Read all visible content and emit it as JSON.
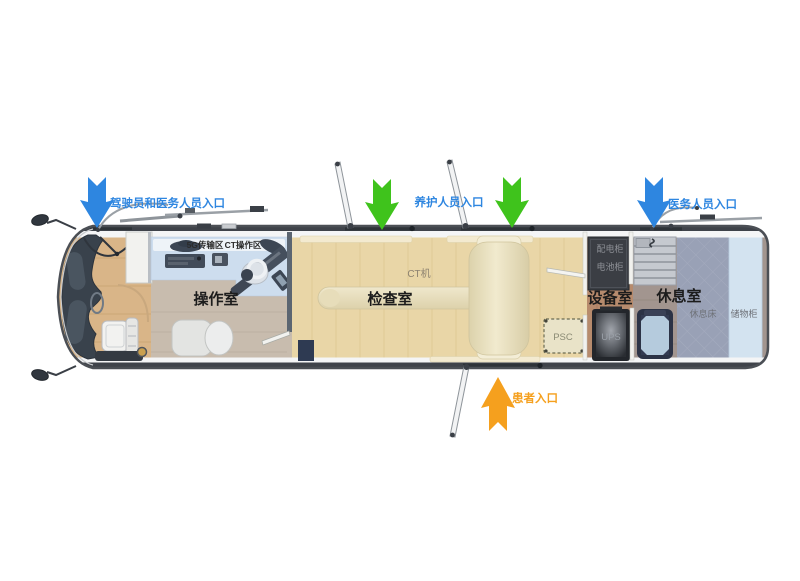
{
  "diagram": {
    "type": "vehicle-floorplan",
    "subject": "mobile CT medical vehicle top view"
  },
  "entrances": {
    "driver_staff": {
      "label": "驾驶员和医务人员入口",
      "arrow_color": "#2e86e0",
      "label_color": "#2e86e0"
    },
    "maintenance": {
      "label": "养护人员入口",
      "arrow_color": "#3fc31c",
      "label_color": "#2e86e0"
    },
    "medical_staff": {
      "label": "医务人员入口",
      "arrow_color": "#2e86e0",
      "label_color": "#2e86e0"
    },
    "patient": {
      "label": "患者入口",
      "arrow_color": "#f5a01e",
      "label_color": "#f5a01e"
    }
  },
  "rooms": {
    "operation": {
      "label": "操作室"
    },
    "examination": {
      "label": "检查室"
    },
    "equipment": {
      "label": "设备室"
    },
    "rest": {
      "label": "休息室"
    }
  },
  "equipment": {
    "five_g_zone": "5G传输区",
    "ct_console_zone": "CT操作区",
    "ct_scanner": "CT机",
    "power_cabinet": "配电柜",
    "battery_cabinet": "电池柜",
    "psc_unit": "PSC",
    "ups_unit": "UPS",
    "rest_bed": "休息床",
    "storage_cabinet": "储物柜"
  }
}
